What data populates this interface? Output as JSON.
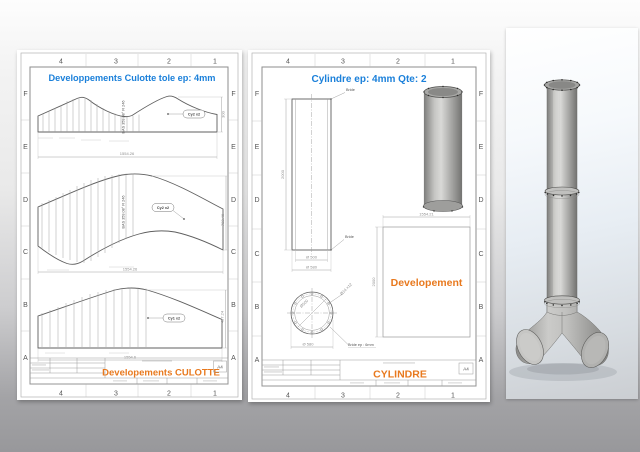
{
  "colors": {
    "title_blue": "#1b80da",
    "accent_orange": "#e8791e",
    "paper": "#ffffff",
    "model_gray": "#b0b0ae"
  },
  "zones": {
    "rows": [
      "F",
      "E",
      "D",
      "C",
      "B",
      "A"
    ],
    "cols": [
      "4",
      "3",
      "2",
      "1"
    ]
  },
  "sheet_culotte": {
    "title": "Developpements Culotte tole ep: 4mm",
    "views": {
      "top": {
        "balloon": "Cy2 x2",
        "width_dim": "1554.26",
        "height_dim": "300",
        "bend_note": "BAS  359.08°  R 246"
      },
      "middle": {
        "balloon": "Cy2 x2",
        "width_dim": "1554.26",
        "height_dim": "782.46",
        "bend_note": "BAS  359.08°  R 246"
      },
      "bottom": {
        "balloon": "Cy1 x2",
        "width_dim": "1554.6",
        "height_dim": "487.24"
      }
    },
    "title_block": {
      "title": "Developements CULOTTE",
      "format": "A4"
    }
  },
  "sheet_cylindre": {
    "title": "Cylindre ep: 4mm  Qte: 2",
    "front_view": {
      "height_dim": "2000",
      "bride_top": "Bride",
      "bride_bottom": "Bride",
      "inner_dia": "Ø 500",
      "outer_dia": "Ø 580"
    },
    "flange_view": {
      "holes": "Ø14 x12",
      "inner_dia": "Ø500",
      "outer_dia": "Ø 580",
      "note": "Bride ep : 6mm"
    },
    "development": {
      "label": "Developement",
      "width_dim": "1554.21",
      "height_dim": "2000"
    },
    "title_block": {
      "title": "CYLINDRE",
      "format": "A4"
    }
  }
}
